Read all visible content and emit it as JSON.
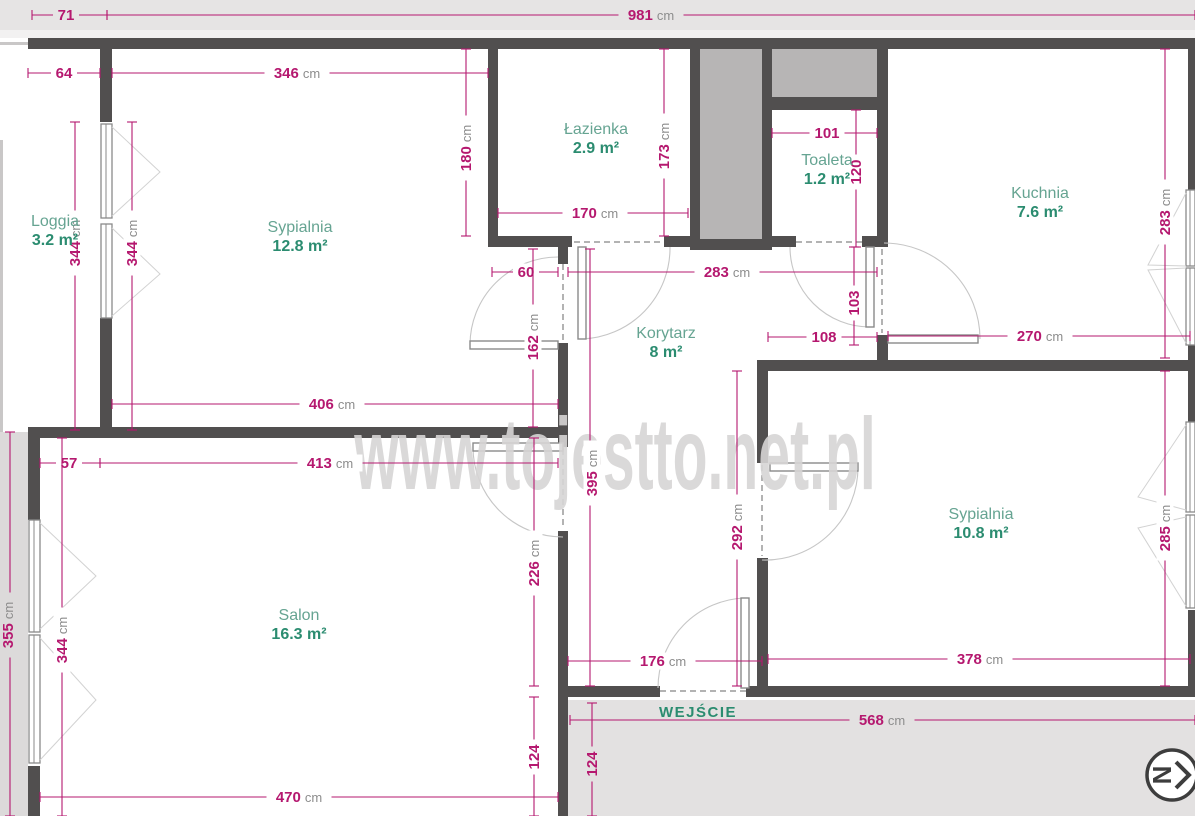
{
  "watermark": "www.tojestto.net.pl",
  "entrance": {
    "label": "WEJŚCIE"
  },
  "north_indicator": {
    "glyph": "N"
  },
  "colors": {
    "dimension": "#b5186f",
    "unit": "#8d8d8d",
    "room_name": "#66a492",
    "room_area": "#2b8c70",
    "wall": "#514f4f",
    "shaft_fill": "#b7b5b5",
    "outside_gray": "#e6e4e4",
    "watermark_gray": "#d7d5d5"
  },
  "rooms": [
    {
      "name": "Loggia",
      "area": "3.2 m²",
      "x": 55,
      "y": 226
    },
    {
      "name": "Sypialnia",
      "area": "12.8 m²",
      "x": 300,
      "y": 232
    },
    {
      "name": "Łazienka",
      "area": "2.9 m²",
      "x": 596,
      "y": 134
    },
    {
      "name": "Toaleta",
      "area": "1.2 m²",
      "x": 827,
      "y": 165
    },
    {
      "name": "Kuchnia",
      "area": "7.6 m²",
      "x": 1040,
      "y": 198
    },
    {
      "name": "Korytarz",
      "area": "8 m²",
      "x": 666,
      "y": 338
    },
    {
      "name": "Salon",
      "area": "16.3 m²",
      "x": 299,
      "y": 620
    },
    {
      "name": "Sypialnia",
      "area": "10.8 m²",
      "x": 981,
      "y": 519
    }
  ],
  "dimensions": [
    {
      "v": "71",
      "u": "",
      "o": "h",
      "x1": 32,
      "y1": 15,
      "x2": 107,
      "y2": 15,
      "tx": 66,
      "ty": 15,
      "bg": "#e6e4e4"
    },
    {
      "v": "981",
      "u": "cm",
      "o": "h",
      "x1": 107,
      "y1": 15,
      "x2": 1195,
      "y2": 15,
      "tx": 651,
      "ty": 15,
      "bg": "#e6e4e4"
    },
    {
      "v": "64",
      "u": "",
      "o": "h",
      "x1": 28,
      "y1": 73,
      "x2": 100,
      "y2": 73,
      "tx": 64,
      "ty": 73,
      "bg": "#ffffff"
    },
    {
      "v": "346",
      "u": "cm",
      "o": "h",
      "x1": 112,
      "y1": 73,
      "x2": 488,
      "y2": 73,
      "tx": 297,
      "ty": 73,
      "bg": "#ffffff"
    },
    {
      "v": "344",
      "u": "cm",
      "o": "v",
      "x1": 75,
      "y1": 122,
      "x2": 75,
      "y2": 430,
      "tx": 75,
      "ty": 243,
      "bg": "#ffffff"
    },
    {
      "v": "344",
      "u": "cm",
      "o": "v",
      "x1": 132,
      "y1": 122,
      "x2": 132,
      "y2": 430,
      "tx": 132,
      "ty": 243,
      "bg": "#ffffff"
    },
    {
      "v": "180",
      "u": "cm",
      "o": "v",
      "x1": 466,
      "y1": 49,
      "x2": 466,
      "y2": 236,
      "tx": 466,
      "ty": 148,
      "bg": "#ffffff"
    },
    {
      "v": "173",
      "u": "cm",
      "o": "v",
      "x1": 664,
      "y1": 49,
      "x2": 664,
      "y2": 236,
      "tx": 664,
      "ty": 146,
      "bg": "#ffffff"
    },
    {
      "v": "170",
      "u": "cm",
      "o": "h",
      "x1": 498,
      "y1": 213,
      "x2": 688,
      "y2": 213,
      "tx": 595,
      "ty": 213,
      "bg": "#ffffff"
    },
    {
      "v": "101",
      "u": "",
      "o": "h",
      "x1": 772,
      "y1": 133,
      "x2": 877,
      "y2": 133,
      "tx": 827,
      "ty": 133,
      "bg": "#ffffff"
    },
    {
      "v": "120",
      "u": "",
      "o": "v",
      "x1": 856,
      "y1": 110,
      "x2": 856,
      "y2": 247,
      "tx": 856,
      "ty": 172,
      "bg": "#ffffff"
    },
    {
      "v": "283",
      "u": "cm",
      "o": "v",
      "x1": 1165,
      "y1": 49,
      "x2": 1165,
      "y2": 358,
      "tx": 1165,
      "ty": 212,
      "bg": "#ffffff"
    },
    {
      "v": "60",
      "u": "",
      "o": "h",
      "x1": 492,
      "y1": 272,
      "x2": 558,
      "y2": 272,
      "tx": 526,
      "ty": 272,
      "bg": "#ffffff"
    },
    {
      "v": "283",
      "u": "cm",
      "o": "h",
      "x1": 568,
      "y1": 272,
      "x2": 877,
      "y2": 272,
      "tx": 727,
      "ty": 272,
      "bg": "#ffffff"
    },
    {
      "v": "103",
      "u": "",
      "o": "v",
      "x1": 854,
      "y1": 247,
      "x2": 854,
      "y2": 345,
      "tx": 854,
      "ty": 303,
      "bg": "#ffffff"
    },
    {
      "v": "108",
      "u": "",
      "o": "h",
      "x1": 768,
      "y1": 337,
      "x2": 877,
      "y2": 337,
      "tx": 824,
      "ty": 337,
      "bg": "#ffffff"
    },
    {
      "v": "270",
      "u": "cm",
      "o": "h",
      "x1": 888,
      "y1": 336,
      "x2": 1190,
      "y2": 336,
      "tx": 1040,
      "ty": 336,
      "bg": "#ffffff"
    },
    {
      "v": "162",
      "u": "cm",
      "o": "v",
      "x1": 533,
      "y1": 249,
      "x2": 533,
      "y2": 427,
      "tx": 533,
      "ty": 337,
      "bg": "#ffffff"
    },
    {
      "v": "406",
      "u": "cm",
      "o": "h",
      "x1": 112,
      "y1": 404,
      "x2": 558,
      "y2": 404,
      "tx": 332,
      "ty": 404,
      "bg": "#ffffff"
    },
    {
      "v": "57",
      "u": "",
      "o": "h",
      "x1": 40,
      "y1": 463,
      "x2": 100,
      "y2": 463,
      "tx": 69,
      "ty": 463,
      "bg": "#ffffff"
    },
    {
      "v": "413",
      "u": "cm",
      "o": "h",
      "x1": 100,
      "y1": 463,
      "x2": 558,
      "y2": 463,
      "tx": 330,
      "ty": 463,
      "bg": "#ffffff"
    },
    {
      "v": "395",
      "u": "cm",
      "o": "v",
      "x1": 590,
      "y1": 249,
      "x2": 590,
      "y2": 686,
      "tx": 592,
      "ty": 473,
      "bg": "#ffffff"
    },
    {
      "v": "292",
      "u": "cm",
      "o": "v",
      "x1": 737,
      "y1": 371,
      "x2": 737,
      "y2": 686,
      "tx": 737,
      "ty": 527,
      "bg": "#ffffff"
    },
    {
      "v": "226",
      "u": "cm",
      "o": "v",
      "x1": 534,
      "y1": 438,
      "x2": 534,
      "y2": 686,
      "tx": 534,
      "ty": 563,
      "bg": "#ffffff"
    },
    {
      "v": "344",
      "u": "cm",
      "o": "v",
      "x1": 62,
      "y1": 438,
      "x2": 62,
      "y2": 816,
      "tx": 62,
      "ty": 640,
      "bg": "#ffffff"
    },
    {
      "v": "355",
      "u": "cm",
      "o": "v",
      "x1": 10,
      "y1": 432,
      "x2": 10,
      "y2": 816,
      "tx": 8,
      "ty": 625,
      "bg": "#dcdada"
    },
    {
      "v": "176",
      "u": "cm",
      "o": "h",
      "x1": 568,
      "y1": 661,
      "x2": 762,
      "y2": 661,
      "tx": 663,
      "ty": 661,
      "bg": "#ffffff"
    },
    {
      "v": "378",
      "u": "cm",
      "o": "h",
      "x1": 768,
      "y1": 659,
      "x2": 1190,
      "y2": 659,
      "tx": 980,
      "ty": 659,
      "bg": "#ffffff"
    },
    {
      "v": "285",
      "u": "cm",
      "o": "v",
      "x1": 1165,
      "y1": 371,
      "x2": 1165,
      "y2": 686,
      "tx": 1165,
      "ty": 528,
      "bg": "#ffffff"
    },
    {
      "v": "568",
      "u": "cm",
      "o": "h",
      "x1": 570,
      "y1": 720,
      "x2": 1195,
      "y2": 720,
      "tx": 882,
      "ty": 720,
      "bg": "#e3e1e1"
    },
    {
      "v": "124",
      "u": "",
      "o": "v",
      "x1": 534,
      "y1": 697,
      "x2": 534,
      "y2": 816,
      "tx": 534,
      "ty": 757,
      "bg": "#ffffff"
    },
    {
      "v": "124",
      "u": "",
      "o": "v",
      "x1": 592,
      "y1": 703,
      "x2": 592,
      "y2": 816,
      "tx": 592,
      "ty": 764,
      "bg": "#e3e1e1"
    },
    {
      "v": "470",
      "u": "cm",
      "o": "h",
      "x1": 40,
      "y1": 797,
      "x2": 558,
      "y2": 797,
      "tx": 299,
      "ty": 797,
      "bg": "#ffffff"
    }
  ]
}
